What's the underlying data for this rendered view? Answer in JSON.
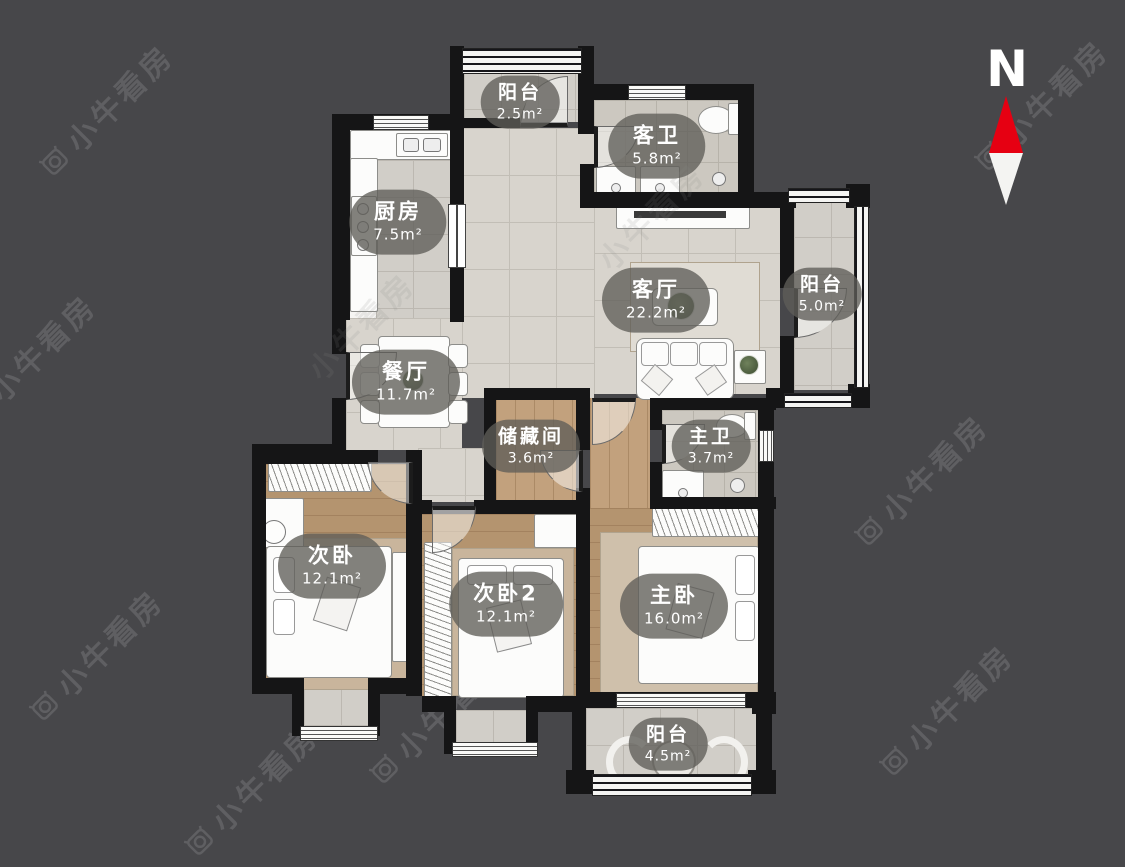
{
  "watermark": {
    "text": "小牛看房"
  },
  "compass": {
    "label": "N"
  },
  "rooms": [
    {
      "id": "balcony-top",
      "name": "阳台",
      "area": "2.5m²"
    },
    {
      "id": "guest-bath",
      "name": "客卫",
      "area": "5.8m²"
    },
    {
      "id": "kitchen",
      "name": "厨房",
      "area": "7.5m²"
    },
    {
      "id": "living-room",
      "name": "客厅",
      "area": "22.2m²"
    },
    {
      "id": "balcony-right",
      "name": "阳台",
      "area": "5.0m²"
    },
    {
      "id": "dining-room",
      "name": "餐厅",
      "area": "11.7m²"
    },
    {
      "id": "storage-room",
      "name": "储藏间",
      "area": "3.6m²"
    },
    {
      "id": "master-bath",
      "name": "主卫",
      "area": "3.7m²"
    },
    {
      "id": "bedroom-2",
      "name": "次卧",
      "area": "12.1m²"
    },
    {
      "id": "bedroom-3",
      "name": "次卧2",
      "area": "12.1m²"
    },
    {
      "id": "master-bedroom",
      "name": "主卧",
      "area": "16.0m²"
    },
    {
      "id": "balcony-bottom",
      "name": "阳台",
      "area": "4.5m²"
    }
  ],
  "colors": {
    "background": "#47474a",
    "wall": "#151516",
    "tile": "#d8d4cd",
    "wood": "#b4946f",
    "label_pill": "rgba(95,93,88,0.78)",
    "compass_red": "#e60012",
    "watermark": "#5f5f62"
  }
}
